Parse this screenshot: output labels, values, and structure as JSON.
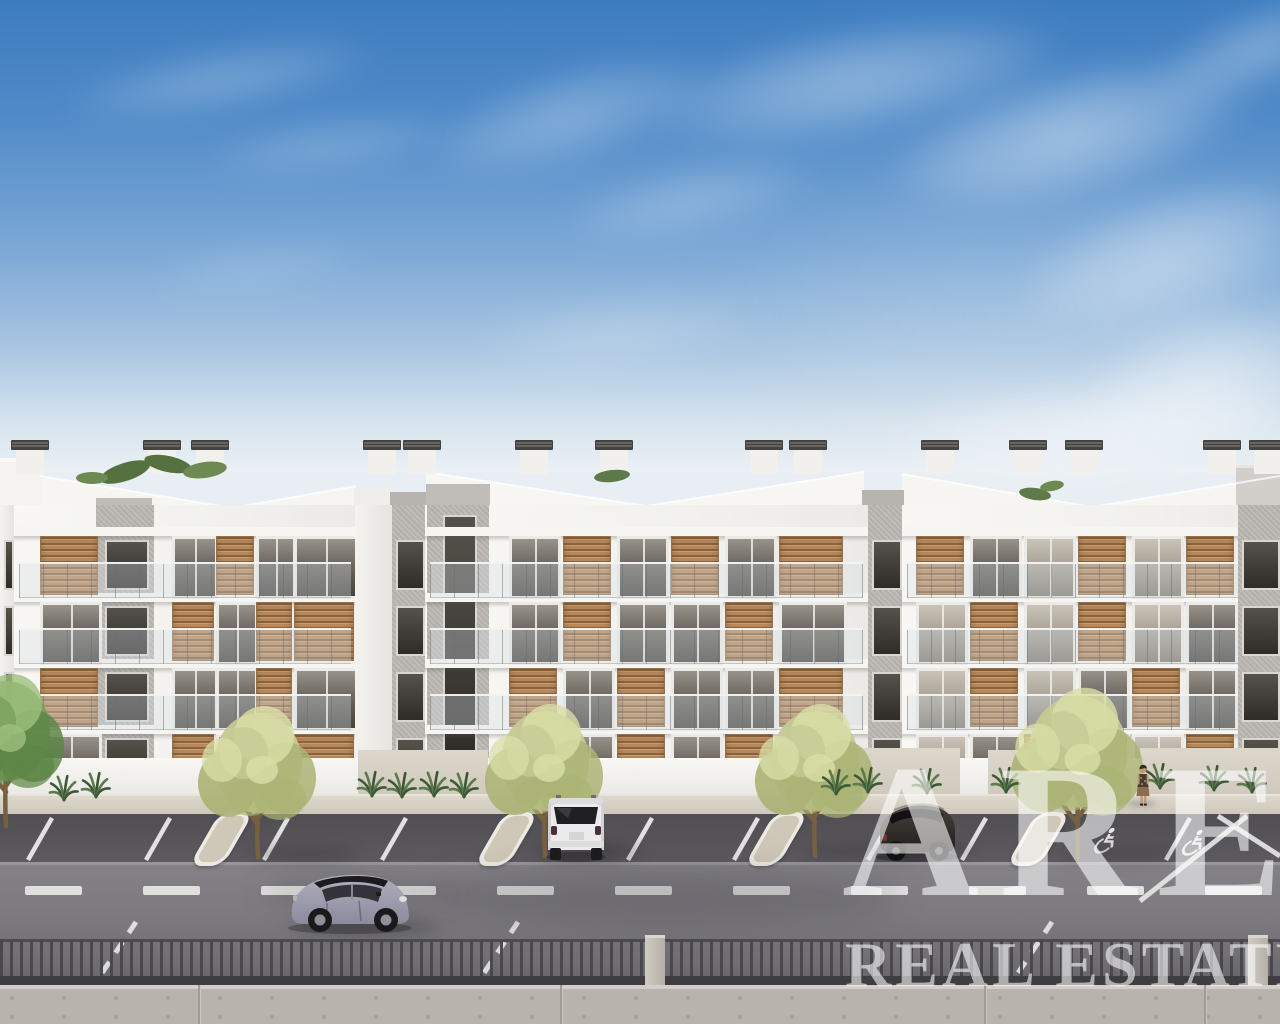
{
  "image": {
    "width": 1280,
    "height": 1024,
    "description": "3D architectural rendering of three modern white four-storey apartment buildings with wooden louver shutters and glass balconies, street-side parking lot with trees, a road with a small car, metal railing fence on a concrete wall, under a blue sky with cirrus clouds"
  },
  "watermark": {
    "brand": "ARE",
    "subtitle": "REAL ESTATE",
    "color": "rgba(255,255,255,0.58)"
  },
  "palette": {
    "sky_top": "#3d7cc0",
    "sky_horizon": "#eaf0f5",
    "facade": "#f5f4f1",
    "gray_core": "#bcb8b3",
    "wood_shutter": "#b5875a",
    "glass_dark": "#46423c",
    "sidewalk": "#d6d0c5",
    "asphalt_lot": "#56545a",
    "asphalt_road": "#7e7c81",
    "island": "#cfc7b7",
    "marking": "#ececea",
    "fence": "#47474b",
    "wall": "#b8b3ad",
    "tree_olive": "#c6c993",
    "tree_green": "#7ba05e"
  },
  "scene": {
    "sky": {
      "height": 472,
      "stops": [
        "#3d7cc0",
        "#4f8ac8 24%",
        "#7aa7d6 52%",
        "#a9c6e2 74%",
        "#d8e4ee 90%",
        "#eaf0f5"
      ]
    },
    "clouds": [
      [
        60,
        48,
        320,
        64,
        0.26,
        -10
      ],
      [
        200,
        118,
        260,
        54,
        0.2,
        -8
      ],
      [
        420,
        70,
        300,
        92,
        0.3,
        -16
      ],
      [
        560,
        165,
        260,
        72,
        0.24,
        -12
      ],
      [
        640,
        26,
        430,
        112,
        0.38,
        -10
      ],
      [
        880,
        70,
        380,
        128,
        0.45,
        -14
      ],
      [
        1010,
        190,
        320,
        130,
        0.4,
        -18
      ],
      [
        1080,
        310,
        260,
        140,
        0.48,
        -10
      ],
      [
        470,
        295,
        300,
        76,
        0.2,
        -6
      ],
      [
        150,
        240,
        220,
        54,
        0.14,
        -8
      ],
      [
        880,
        380,
        420,
        100,
        0.45,
        -4
      ],
      [
        1150,
        8,
        220,
        80,
        0.34,
        -20
      ],
      [
        700,
        150,
        640,
        320,
        0.14,
        0
      ]
    ],
    "skyline": {
      "polys": [
        {
          "pts": "14,524 14,479 40,476 232,508 356,486 356,524",
          "fill": "#f6f5f2"
        },
        {
          "pts": "426,524 426,472 646,506 864,472 864,524",
          "fill": "#f7f6f3"
        },
        {
          "pts": "902,524 902,474 1092,507 1280,476 1280,524",
          "fill": "#f6f5f2"
        }
      ],
      "edges": [
        "40,476 232,508 356,486",
        "426,472 646,506 864,472",
        "902,474 1092,507 1280,476"
      ],
      "rects": [
        {
          "x": 0,
          "y": 458,
          "w": 44,
          "h": 5,
          "fill": "#fbfaf8"
        },
        {
          "x": 0,
          "y": 462,
          "w": 42,
          "h": 62,
          "fill": "#f4f3f0"
        },
        {
          "x": 354,
          "y": 488,
          "w": 38,
          "h": 36,
          "fill": "#efeeeb"
        },
        {
          "x": 390,
          "y": 492,
          "w": 36,
          "h": 32,
          "fill": "#b7b3ae"
        },
        {
          "x": 426,
          "y": 484,
          "w": 64,
          "h": 40,
          "fill": "#c0bcb7"
        },
        {
          "x": 96,
          "y": 498,
          "w": 56,
          "h": 26,
          "fill": "#c0bcb7"
        },
        {
          "x": 862,
          "y": 490,
          "w": 42,
          "h": 34,
          "fill": "#b7b3ae"
        },
        {
          "x": 1236,
          "y": 465,
          "w": 44,
          "h": 5,
          "fill": "#e8e5e1"
        },
        {
          "x": 1236,
          "y": 468,
          "w": 44,
          "h": 56,
          "fill": "#d2cfca"
        }
      ],
      "chimneys": [
        16,
        148,
        196,
        368,
        408,
        520,
        600,
        750,
        794,
        926,
        1014,
        1070,
        1208,
        1254
      ],
      "chimney_y": 450,
      "greens": [
        [
          125,
          472,
          26,
          9,
          -18,
          "#55713f"
        ],
        [
          168,
          464,
          24,
          8,
          12,
          "#55713f"
        ],
        [
          205,
          470,
          22,
          8,
          -8,
          "#6d8a52"
        ],
        [
          92,
          478,
          16,
          6,
          0,
          "#6d8a52"
        ],
        [
          612,
          476,
          18,
          6,
          -6,
          "#5d7a48"
        ],
        [
          1035,
          494,
          16,
          6,
          8,
          "#5d7a48"
        ],
        [
          1052,
          486,
          12,
          5,
          -10,
          "#6d8a52"
        ]
      ]
    },
    "rows": {
      "slab_y": [
        527,
        593,
        659,
        725
      ],
      "win_y": [
        536,
        602,
        668,
        734
      ],
      "win_h": [
        57,
        57,
        57,
        56
      ],
      "top": 505,
      "bottom": 798
    },
    "buildings": [
      {
        "x": 14,
        "w": 342,
        "strip": {
          "x": 82,
          "w": 58
        },
        "cols": [
          [
            26,
            56
          ],
          [
            158,
            40
          ],
          [
            202,
            36
          ],
          [
            242,
            34
          ],
          [
            280,
            58
          ]
        ],
        "floors": [
          [
            "s",
            "w",
            "s",
            "w",
            "w"
          ],
          [
            "w",
            "s",
            "w",
            "s",
            "s"
          ],
          [
            "s",
            "w",
            "w",
            "s",
            "w"
          ],
          [
            "w",
            "s",
            "w",
            "w",
            "s"
          ]
        ]
      },
      {
        "x": 425,
        "w": 443,
        "strip": {
          "x": 2,
          "w": 62
        },
        "tall_strip": true,
        "cols": [
          [
            84,
            46
          ],
          [
            138,
            46
          ],
          [
            192,
            46
          ],
          [
            246,
            46
          ],
          [
            300,
            46
          ],
          [
            354,
            62
          ]
        ],
        "floors": [
          [
            "w",
            "s",
            "w",
            "s",
            "w",
            "s"
          ],
          [
            "w",
            "s",
            "w",
            "w",
            "s",
            "w"
          ],
          [
            "s",
            "w",
            "s",
            "w",
            "w",
            "s"
          ],
          [
            "w",
            "w",
            "s",
            "w",
            "s",
            "w"
          ]
        ]
      },
      {
        "x": 902,
        "w": 378,
        "lite": true,
        "cols": [
          [
            14,
            46
          ],
          [
            68,
            46
          ],
          [
            122,
            46
          ],
          [
            176,
            46
          ],
          [
            230,
            46
          ],
          [
            284,
            46
          ]
        ],
        "floors": [
          [
            "s",
            "w",
            "w",
            "s",
            "w",
            "s"
          ],
          [
            "w",
            "s",
            "w",
            "s",
            "w",
            "w"
          ],
          [
            "w",
            "s",
            "w",
            "w",
            "s",
            "w"
          ],
          [
            "w",
            "w",
            "s",
            "w",
            "w",
            "s"
          ]
        ]
      }
    ],
    "connectors": [
      {
        "x": 0,
        "w": 14,
        "type": "white",
        "win": true
      },
      {
        "x": 355,
        "w": 37,
        "type": "white"
      },
      {
        "x": 392,
        "w": 33,
        "type": "gray",
        "win": true
      },
      {
        "x": 868,
        "w": 34,
        "type": "gray",
        "win": true
      },
      {
        "x": 1238,
        "w": 42,
        "type": "gray",
        "win": true
      }
    ],
    "ground": {
      "parapet_y": 758,
      "parapet_h": 38,
      "gravel": [
        [
          358,
          750,
          130
        ],
        [
          820,
          748,
          140
        ],
        [
          988,
          750,
          90
        ],
        [
          1140,
          748,
          140
        ]
      ],
      "sidewalk_y": 794,
      "sidewalk_h": 22,
      "lot_y": 814,
      "lot_h": 50,
      "road_y": 862,
      "road_h": 126,
      "stall_lines": [
        52,
        170,
        288,
        406,
        652,
        758,
        892,
        986,
        1190
      ],
      "special_lines": [
        [
          1247,
          816,
          1140,
          901
        ],
        [
          1218,
          816,
          1280,
          856
        ]
      ],
      "hatch_x": [
        100,
        482,
        1016
      ],
      "dash": {
        "y": 886,
        "h": 9,
        "w": 57,
        "step": 118,
        "start": 25
      },
      "wheelchairs": [
        [
          1104,
          828
        ],
        [
          1192,
          830
        ]
      ],
      "islands": [
        245,
        530,
        800,
        1062
      ]
    },
    "trees": [
      {
        "cx": 258,
        "base": 858,
        "pal": 0,
        "big": false
      },
      {
        "cx": 545,
        "base": 856,
        "pal": 0,
        "big": false
      },
      {
        "cx": 815,
        "base": 856,
        "pal": 0,
        "big": false
      },
      {
        "cx": 1078,
        "base": 858,
        "pal": 0,
        "big": true
      },
      {
        "cx": 6,
        "base": 826,
        "pal": 1,
        "big": false
      }
    ],
    "tree_palettes": [
      [
        "#c6c993",
        "#aab374",
        "#dadfa8"
      ],
      [
        "#7ba05e",
        "#5d8546",
        "#9ebf7d"
      ]
    ],
    "agaves": [
      [
        64,
        798
      ],
      [
        96,
        795
      ],
      [
        372,
        794
      ],
      [
        402,
        795
      ],
      [
        434,
        794
      ],
      [
        464,
        795
      ],
      [
        836,
        792
      ],
      [
        868,
        790
      ],
      [
        927,
        791
      ],
      [
        1006,
        790
      ],
      [
        1160,
        786
      ],
      [
        1214,
        788
      ],
      [
        1252,
        790
      ]
    ],
    "cars": {
      "fiat": {
        "x": 280,
        "y": 862,
        "body1": "#b0afc0",
        "body2": "#8c8b9d",
        "roof": "#1c1a1d",
        "glass": "#35323a"
      },
      "suv": {
        "x": 544,
        "y": 788,
        "body": "#ebebed",
        "glass": "#211f23"
      },
      "dark": {
        "x": 872,
        "y": 794,
        "body1": "#46413c",
        "body2": "#211e1c",
        "glass": "#121012"
      }
    },
    "person": {
      "x": 1128,
      "y": 762,
      "skin": "#c1977a",
      "hair": "#3a2b21",
      "top": "#4c3a2e",
      "skirt": "#8a6d52"
    },
    "shadows": [
      [
        430,
        868,
        470,
        56,
        0.2,
        16
      ],
      [
        260,
        872,
        200,
        40,
        0.12,
        12
      ],
      [
        248,
        846,
        110,
        16,
        0.26,
        7
      ],
      [
        535,
        844,
        110,
        16,
        0.26,
        7
      ],
      [
        805,
        844,
        110,
        16,
        0.26,
        7
      ],
      [
        1060,
        846,
        120,
        16,
        0.26,
        7
      ],
      [
        292,
        918,
        150,
        18,
        0.34,
        8
      ],
      [
        540,
        846,
        80,
        14,
        0.28,
        6
      ],
      [
        874,
        842,
        100,
        16,
        0.3,
        6
      ],
      [
        1126,
        800,
        30,
        7,
        0.22,
        3
      ]
    ],
    "fence": {
      "y": 941,
      "h": 40,
      "bar": "#47474b",
      "toprail_y": 939,
      "rail_y": 976,
      "rail_h": 9,
      "rail": "#3e3e42",
      "pillars": [
        645,
        1248
      ]
    },
    "wall": {
      "y": 985,
      "h": 39,
      "fill": "#b8b3ad",
      "cap": "#d3cec7",
      "joints": [
        198,
        560,
        984,
        1204
      ]
    }
  }
}
